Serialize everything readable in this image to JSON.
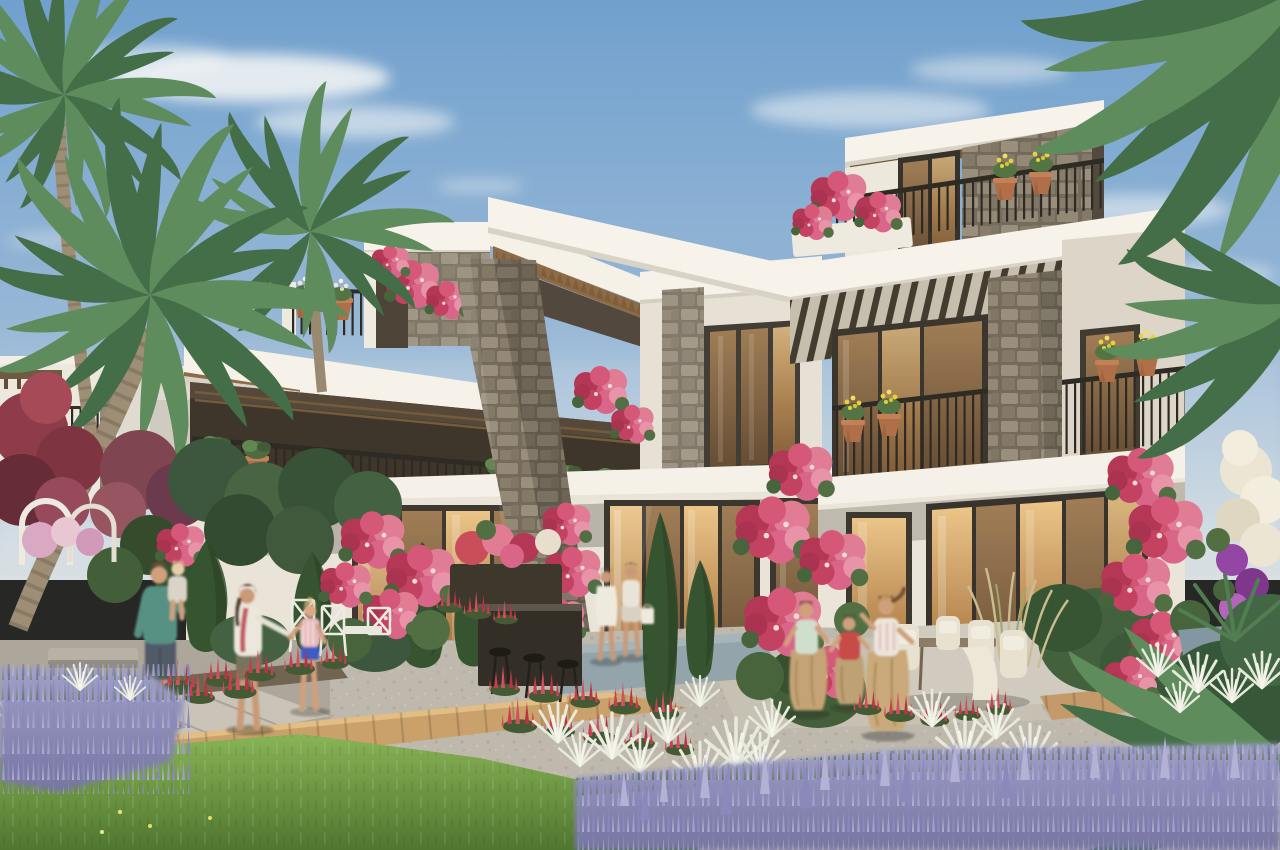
{
  "image": {
    "type": "architectural-rendering",
    "subject": "Modern two and three storey townhouse villas with roof terraces, stone-clad columns, timber pergolas and flowering gardens",
    "time_of_day": "sunny afternoon",
    "sky": "blue with wispy white clouds"
  },
  "palette": {
    "sky_top": "#6b9fd2",
    "sky_mid": "#93b7dc",
    "sky_horizon": "#d8e2e9",
    "facade_white": "#f6f4ef",
    "facade_shadow": "#d9d5ce",
    "wall_grey": "#e6e2db",
    "stone_mortar": "#6e675b",
    "stone_light": "#968d7d",
    "stone_mid": "#847b6c",
    "timber": "#6b5138",
    "soffit_wood": "#8a6744",
    "railing_black": "#24221f",
    "terracotta": "#ad6b47",
    "glass_warm_bright": "#ecc58a",
    "glass_warm_dark": "#8a5f38",
    "palm_green_light": "#57895b",
    "palm_green_dark": "#3c6a45",
    "cypress_green": "#2e4f2e",
    "bush_green": "#3a5a36",
    "lawn_light": "#84b355",
    "lawn_dark": "#47732c",
    "lavender_light": "#b0b1da",
    "lavender_mid": "#8486bf",
    "lavender_base": "#6f71a3",
    "salvia_red": "#c9364a",
    "bougainvillea_pink": "#d5537a",
    "bougainvillea_deep": "#b23055",
    "petunia_purple": "#9040a8",
    "blossom_white": "#ece7d8",
    "gravel": "#bdb9b0",
    "concrete": "#c9c5bc",
    "boardwalk": "#c9a06b",
    "mat_blue": "#8fa3ae",
    "man_shirt_teal": "#4f8f84",
    "girl_shorts_blue": "#3059c8",
    "boy_shirt_red": "#c64545",
    "sack_tan": "#c3a277",
    "skin": "#cf9f7e"
  },
  "labels": {
    "scene": "Rendering of a townhouse villa development with landscaped garden",
    "sky": "Blue afternoon sky",
    "clouds": "Wispy white clouds",
    "background_buildings": "Neighbouring white villas in the background",
    "villa_left": "Left villa with roof structure and covered balcony",
    "villa_center": "Middle villa section with picture window",
    "villa_right": "Right three-storey villa with roof terrace",
    "roof_box_left": "Left roof terrace structure with stone panel",
    "roof_terrace_railing": "Roof terrace railing with planters",
    "pergola_rafters": "Timber pergola rafters",
    "pergola_slats": "Slatted pergola screen",
    "stone_column_left": "Stone clad column, left villa",
    "stone_column_right": "Stone clad column, right villa",
    "balcony_left": "Covered balcony with hanging planters",
    "balcony_railing_right": "Right villa balcony railing with flower pots",
    "picture_window": "Dark framed picture window",
    "glass_doors_left": "Glass doors of the left villa",
    "glass_doors_center": "Glass doors of the middle villa",
    "glass_doors_right": "Large glass doors of the right villa",
    "hanging_planters": "Terracotta hanging planters",
    "bougainvillea_left": "Climbing bougainvillea on the left facade",
    "bougainvillea_center": "Climbing bougainvillea between the doors",
    "bougainvillea_right": "Climbing bougainvillea on the right facade",
    "bougainvillea_roof": "Bougainvillea on the roof terraces",
    "flower_tower": "White and purple flowering shrub",
    "palms_left": "Tall palm trees on the left",
    "palms_right": "Overhanging palm fronds, top right",
    "tropical_right": "Tropical planting at the right edge",
    "red_shrub": "Red leaved shrub",
    "white_arbor": "White garden arches with hydrangeas",
    "bench": "Concrete garden bench",
    "cypresses": "Cypresses and clipped shrubs",
    "tall_grasses": "Tall ornamental grasses",
    "salvia_beds": "Red salvia flower beds",
    "white_grasses": "White fluffy ornamental grasses",
    "lavender_left": "Lavender bed, bottom left",
    "lavender_right": "Lavender bed, bottom right",
    "lawn": "Green lawn",
    "gravel_path": "Gravel garden path",
    "concrete_path": "Concrete paver path",
    "boardwalk": "Timber boardwalk",
    "deck_right": "Timber deck by the right villa",
    "blue_mat": "Blue-grey outdoor mat",
    "bar_counter": "Dark bar counter with stools",
    "white_chairs": "White garden dining chairs",
    "dining_set": "Outdoor dining set with cream chairs",
    "lounge": "White garden lounger",
    "man_with_child": "Father carrying a toddler",
    "mother_with_girl": "Mother walking hand in hand with her daughter",
    "women_walking": "Two women walking past the glass doors",
    "sack_race": "Three children racing in jute sacks"
  },
  "people": [
    {
      "name": "father-with-toddler",
      "clothing": "teal sweater, dark shorts, tan boots"
    },
    {
      "name": "mother",
      "clothing": "white blouse, red scarf, olive shorts"
    },
    {
      "name": "daughter",
      "clothing": "pink striped top, blue shorts"
    },
    {
      "name": "woman-in-white-dress",
      "clothing": "white dress"
    },
    {
      "name": "woman-with-bag",
      "clothing": "white top, light skirt, shopper bag"
    },
    {
      "name": "sack-race-girl-left",
      "clothing": "mint tank top, jute sack"
    },
    {
      "name": "sack-race-boy",
      "clothing": "red t-shirt, jute sack"
    },
    {
      "name": "sack-race-girl-front",
      "clothing": "white-pink tank top, jute sack"
    }
  ]
}
